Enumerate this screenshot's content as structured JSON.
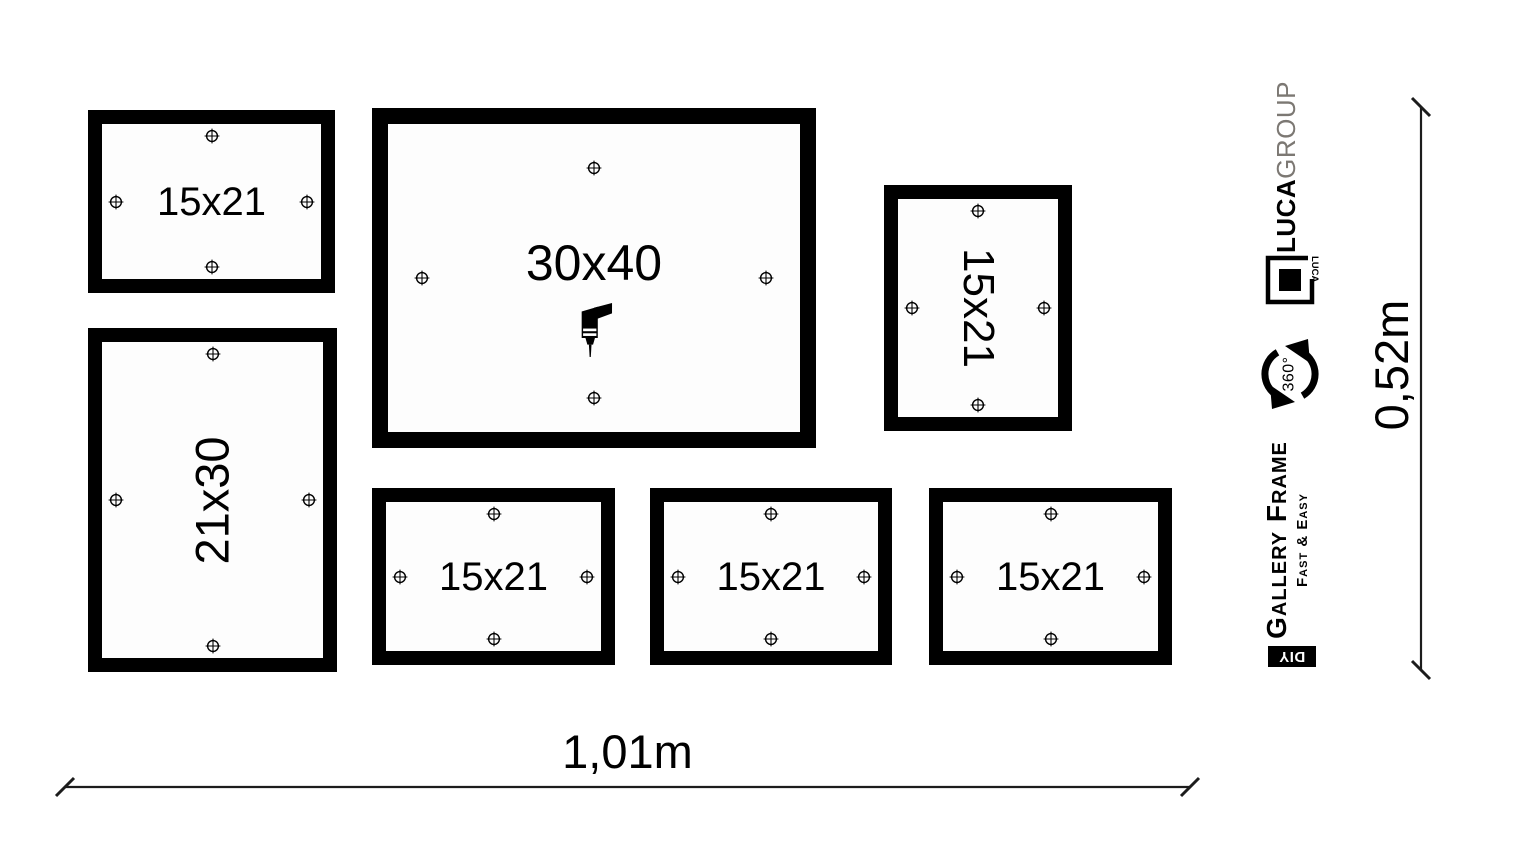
{
  "diagram": {
    "frames": [
      "15x21",
      "30x40",
      "15x21",
      "21x30",
      "15x21",
      "15x21",
      "15x21"
    ],
    "dimensions": {
      "width": "1,01m",
      "height": "0,52m"
    }
  },
  "branding": {
    "company_bold": "LUCA",
    "company_light": "GROUP",
    "logo_text": "LUCA",
    "rotate_label": "360°",
    "product_name": "Gallery Frame",
    "tagline": "Fast & Easy",
    "diy_label": "DIY"
  },
  "icons": {
    "marker": "crosshair-drill-point-icon",
    "drill": "drill-icon",
    "rotate": "rotate-360-icon"
  },
  "colors": {
    "ink": "#000000",
    "muted_gray": "#7c7873",
    "background": "#ffffff"
  }
}
